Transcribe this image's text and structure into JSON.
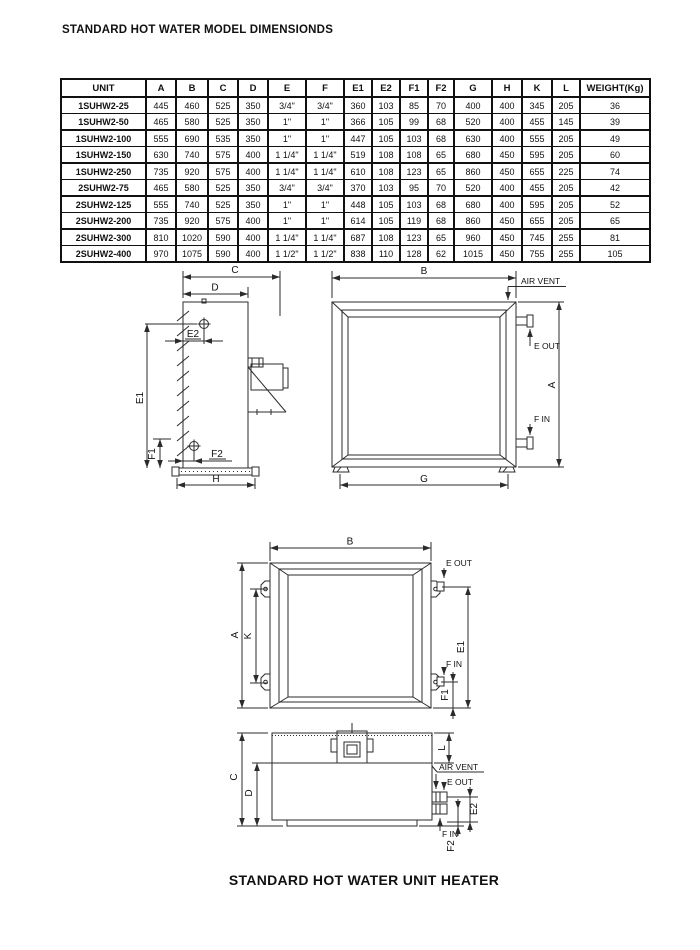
{
  "page": {
    "title": "STANDARD HOT WATER MODEL DIMENSIONDS",
    "caption": "STANDARD HOT WATER UNIT HEATER",
    "ink_color": "#1a1a1a"
  },
  "table": {
    "columns": [
      "UNIT",
      "A",
      "B",
      "C",
      "D",
      "E",
      "F",
      "E1",
      "E2",
      "F1",
      "F2",
      "G",
      "H",
      "K",
      "L",
      "WEIGHT(Kg)"
    ],
    "group_starts": [
      0,
      2,
      4,
      6,
      8
    ],
    "rows": [
      {
        "unit": "1SUHW2-25",
        "values": [
          "445",
          "460",
          "525",
          "350",
          "3/4\"",
          "3/4\"",
          "360",
          "103",
          "85",
          "70",
          "400",
          "400",
          "345",
          "205",
          "36"
        ]
      },
      {
        "unit": "1SUHW2-50",
        "values": [
          "465",
          "580",
          "525",
          "350",
          "1\"",
          "1\"",
          "366",
          "105",
          "99",
          "68",
          "520",
          "400",
          "455",
          "145",
          "39"
        ]
      },
      {
        "unit": "1SUHW2-100",
        "values": [
          "555",
          "690",
          "535",
          "350",
          "1\"",
          "1\"",
          "447",
          "105",
          "103",
          "68",
          "630",
          "400",
          "555",
          "205",
          "49"
        ]
      },
      {
        "unit": "1SUHW2-150",
        "values": [
          "630",
          "740",
          "575",
          "400",
          "1 1/4\"",
          "1 1/4\"",
          "519",
          "108",
          "108",
          "65",
          "680",
          "450",
          "595",
          "205",
          "60"
        ]
      },
      {
        "unit": "1SUHW2-250",
        "values": [
          "735",
          "920",
          "575",
          "400",
          "1 1/4\"",
          "1 1/4\"",
          "610",
          "108",
          "123",
          "65",
          "860",
          "450",
          "655",
          "225",
          "74"
        ]
      },
      {
        "unit": "2SUHW2-75",
        "values": [
          "465",
          "580",
          "525",
          "350",
          "3/4\"",
          "3/4\"",
          "370",
          "103",
          "95",
          "70",
          "520",
          "400",
          "455",
          "205",
          "42"
        ]
      },
      {
        "unit": "2SUHW2-125",
        "values": [
          "555",
          "740",
          "525",
          "350",
          "1\"",
          "1\"",
          "448",
          "105",
          "103",
          "68",
          "680",
          "400",
          "595",
          "205",
          "52"
        ]
      },
      {
        "unit": "2SUHW2-200",
        "values": [
          "735",
          "920",
          "575",
          "400",
          "1\"",
          "1\"",
          "614",
          "105",
          "119",
          "68",
          "860",
          "450",
          "655",
          "205",
          "65"
        ]
      },
      {
        "unit": "2SUHW2-300",
        "values": [
          "810",
          "1020",
          "590",
          "400",
          "1 1/4\"",
          "1 1/4\"",
          "687",
          "108",
          "123",
          "65",
          "960",
          "450",
          "745",
          "255",
          "81"
        ]
      },
      {
        "unit": "2SUHW2-400",
        "values": [
          "970",
          "1075",
          "590",
          "400",
          "1 1/2\"",
          "1 1/2\"",
          "838",
          "110",
          "128",
          "62",
          "1015",
          "450",
          "755",
          "255",
          "105"
        ]
      }
    ]
  },
  "drawings": {
    "side_view": {
      "labels": {
        "c": "C",
        "d": "D",
        "e2": "E2",
        "e1": "E1",
        "f1": "F1",
        "f2": "F2",
        "h": "H"
      }
    },
    "front_view": {
      "labels": {
        "b": "B",
        "air_vent": "AIR VENT",
        "e_out": "E OUT",
        "f_in": "F IN",
        "a": "A",
        "g": "G"
      }
    },
    "mounting_view": {
      "labels": {
        "b": "B",
        "a": "A",
        "k": "K",
        "e_out": "E OUT",
        "e1": "E1",
        "f_in": "F IN",
        "f1": "F1"
      }
    },
    "top_view": {
      "labels": {
        "c": "C",
        "d": "D",
        "l": "L",
        "air_vent": "AIR VENT",
        "e_out": "E OUT",
        "f_in": "F IN",
        "e2": "E2",
        "f2": "F2"
      }
    }
  }
}
